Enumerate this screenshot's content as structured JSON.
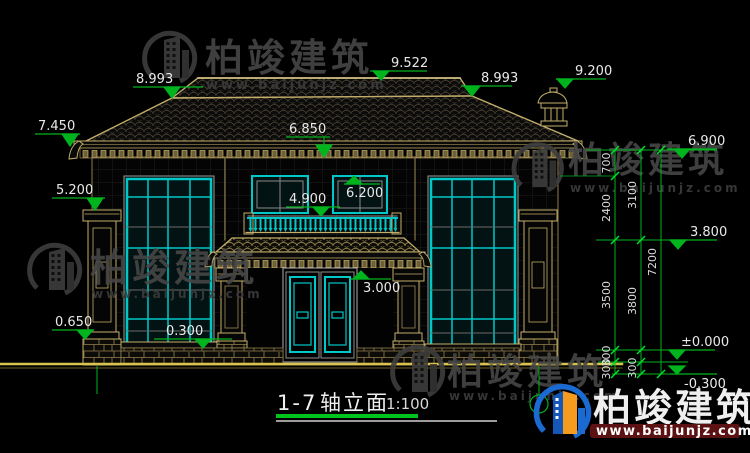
{
  "page": {
    "background": "#000000"
  },
  "title": {
    "axis": "1-7",
    "name": "轴立面",
    "scale": "1:100"
  },
  "watermark": {
    "brand": "柏竣建筑",
    "url": "www.baijunjz.com"
  },
  "logo": {
    "brand": "柏竣建筑",
    "url": "www.baijunjz.com"
  },
  "elevations": {
    "ridge": "9.522",
    "roof_left": "8.993",
    "roof_right": "8.993",
    "chimney": "9.200",
    "eave_left": "7.450",
    "balcony_eave": "6.850",
    "eave_right": "6.900",
    "window2_top": "6.200",
    "pillar_cap": "5.200",
    "window2_sill": "4.900",
    "floor2": "3.800",
    "porch_ceiling": "3.000",
    "plinth": "0.650",
    "window_sill": "0.300",
    "zero": "±0.000",
    "ground": "-0.300"
  },
  "chain": {
    "c700": "700",
    "c2400": "2400",
    "c3100": "3100",
    "c3500": "3500",
    "c3800": "3800",
    "c7200": "7200",
    "c300a": "300",
    "c300b": "300",
    "c300c": "300"
  },
  "colors": {
    "cad_line": "#c2ae6a",
    "window_frame": "#00c8c8",
    "dimension_green": "#00b41e",
    "ground_yellow": "#d9c24e",
    "logo_blue": "#1a6ad2",
    "logo_orange": "#f59b20"
  }
}
